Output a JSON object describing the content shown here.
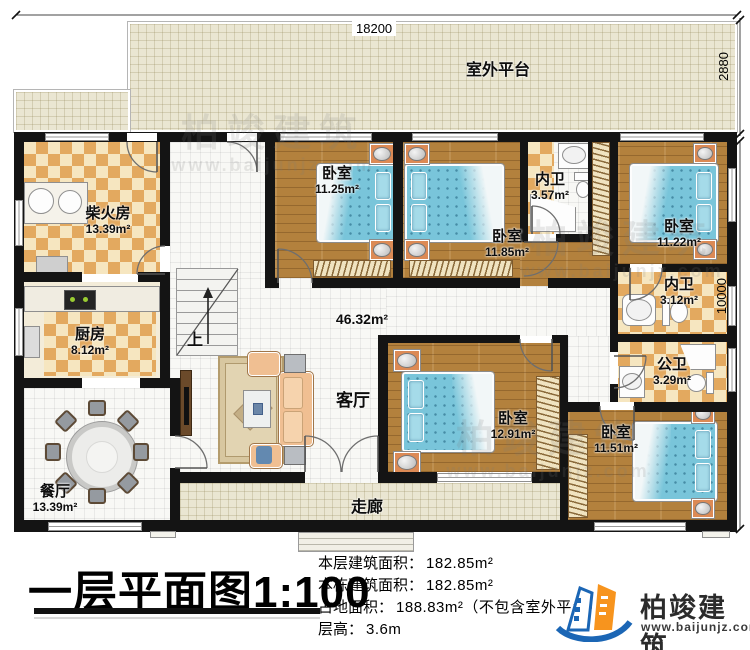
{
  "plan": {
    "title": "一层平面图1:100",
    "dims": {
      "top": "18200",
      "platform_depth": "2880",
      "house_depth": "10000"
    },
    "platform": {
      "name": "室外平台"
    },
    "rooms": {
      "chai": {
        "name": "柴火房",
        "area": "13.39m²"
      },
      "kitchen": {
        "name": "厨房",
        "area": "8.12m²"
      },
      "dining": {
        "name": "餐厅",
        "area": "13.39m²"
      },
      "living": {
        "name": "客厅",
        "area": "46.32m²"
      },
      "corridor": {
        "name": "走廊"
      },
      "bed1": {
        "name": "卧室",
        "area": "11.25m²"
      },
      "bed2": {
        "name": "卧室",
        "area": "11.85m²"
      },
      "bed3": {
        "name": "卧室",
        "area": "11.22m²"
      },
      "bed4": {
        "name": "卧室",
        "area": "12.91m²"
      },
      "bed5": {
        "name": "卧室",
        "area": "11.51m²"
      },
      "neiwei1": {
        "name": "内卫",
        "area": "3.57m²"
      },
      "neiwei2": {
        "name": "内卫",
        "area": "3.12m²"
      },
      "gongwei": {
        "name": "公卫",
        "area": "3.29m²"
      }
    },
    "stairs": {
      "up_label": "上"
    }
  },
  "info": {
    "floor_area_label": "本层建筑面积：",
    "floor_area_value": "182.85m²",
    "building_area_label": "本栋建筑面积：",
    "building_area_value": "182.85m²",
    "land_area_label": "占地面积：",
    "land_area_value": "188.83m²（不包含室外平台）",
    "height_label": "层高：",
    "height_value": "3.6m"
  },
  "brand": {
    "name": "柏竣建筑",
    "website": "www.baijunjz.com"
  },
  "watermark": {
    "name": "柏竣建筑",
    "website": "www.baijunjz.com"
  }
}
